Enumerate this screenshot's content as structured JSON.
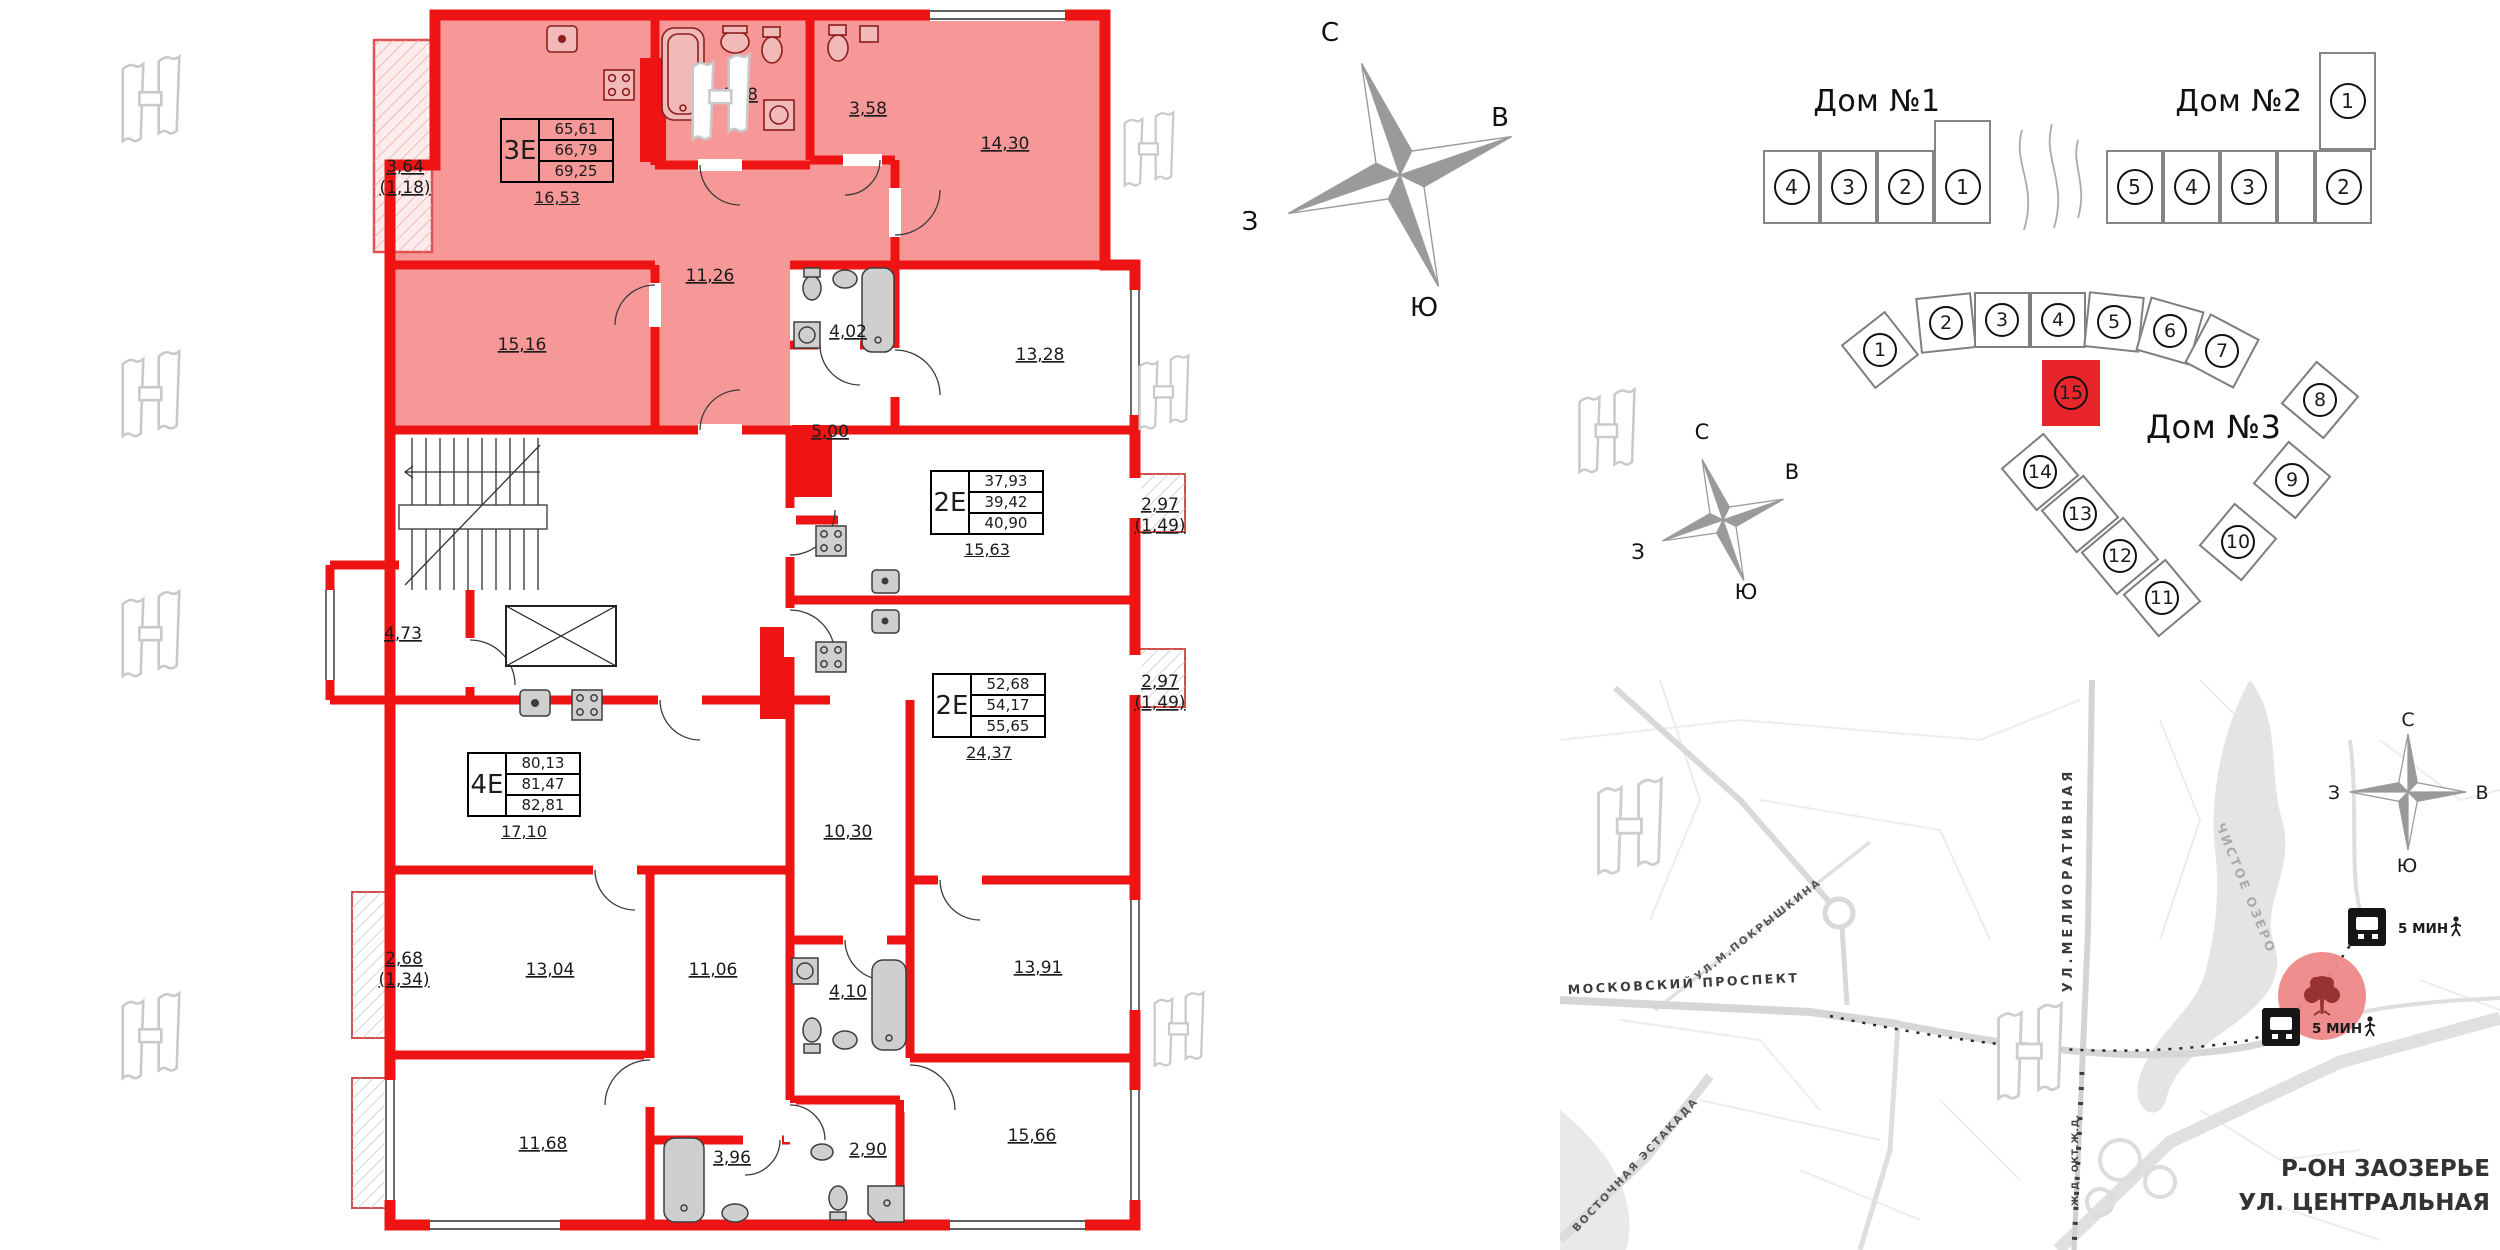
{
  "compass": {
    "north": "С",
    "east": "В",
    "south": "Ю",
    "west": "З"
  },
  "plan": {
    "apartments": [
      {
        "type": "3Е",
        "area_rows": [
          "65,61",
          "66,79",
          "69,25"
        ],
        "area_below": "16,53"
      },
      {
        "type": "2Е",
        "area_rows": [
          "37,93",
          "39,42",
          "40,90"
        ],
        "area_below": "15,63"
      },
      {
        "type": "2Е",
        "area_rows": [
          "52,68",
          "54,17",
          "55,65"
        ],
        "area_below": "24,37"
      },
      {
        "type": "4Е",
        "area_rows": [
          "80,13",
          "81,47",
          "82,81"
        ],
        "area_below": "17,10"
      }
    ],
    "rooms": [
      "3,64",
      "(1,18)",
      "4,78",
      "3,58",
      "14,30",
      "11,26",
      "15,16",
      "4,02",
      "13,28",
      "5,00",
      "2,97",
      "(1,49)",
      "2,97",
      "(1,49)",
      "10,30",
      "4,73",
      "2,68",
      "(1,34)",
      "13,04",
      "11,06",
      "4,10",
      "13,91",
      "11,68",
      "3,96",
      "2,90",
      "15,66"
    ]
  },
  "buildings": {
    "dom1": {
      "name": "Дом №1",
      "sections": [
        "4",
        "3",
        "2",
        "1"
      ]
    },
    "dom2": {
      "name": "Дом №2",
      "sections": [
        "5",
        "4",
        "3",
        "2"
      ],
      "upper_section": "1"
    },
    "dom3": {
      "name": "Дом №3",
      "top_sections": [
        "1",
        "2",
        "3",
        "4",
        "5",
        "6",
        "7"
      ],
      "right_sections": [
        "8",
        "9"
      ],
      "bottom_sections": [
        "14",
        "13",
        "12",
        "11",
        "10"
      ],
      "highlighted_section": "15"
    }
  },
  "map": {
    "streets": {
      "moskovsky": "МОСКОВСКИЙ ПРОСПЕКТ",
      "meliorativnaya": "УЛ.МЕЛИОРАТИВНАЯ",
      "pokryshkina": "УЛ.М.ПОКРЫШКИНА",
      "estakada": "ВОСТОЧНАЯ ЭСТАКАДА",
      "railway": "Ж.Д. ОКТ.Ж.Д."
    },
    "lake_label": "ЧИСТОЕ ОЗЕРО",
    "bus_stops": [
      {
        "walk_time": "5 МИН"
      },
      {
        "walk_time": "5 МИН"
      }
    ],
    "district": {
      "line1": "Р-ОН ЗАОЗЕРЬЕ",
      "line2": "УЛ. ЦЕНТРАЛЬНАЯ"
    }
  }
}
